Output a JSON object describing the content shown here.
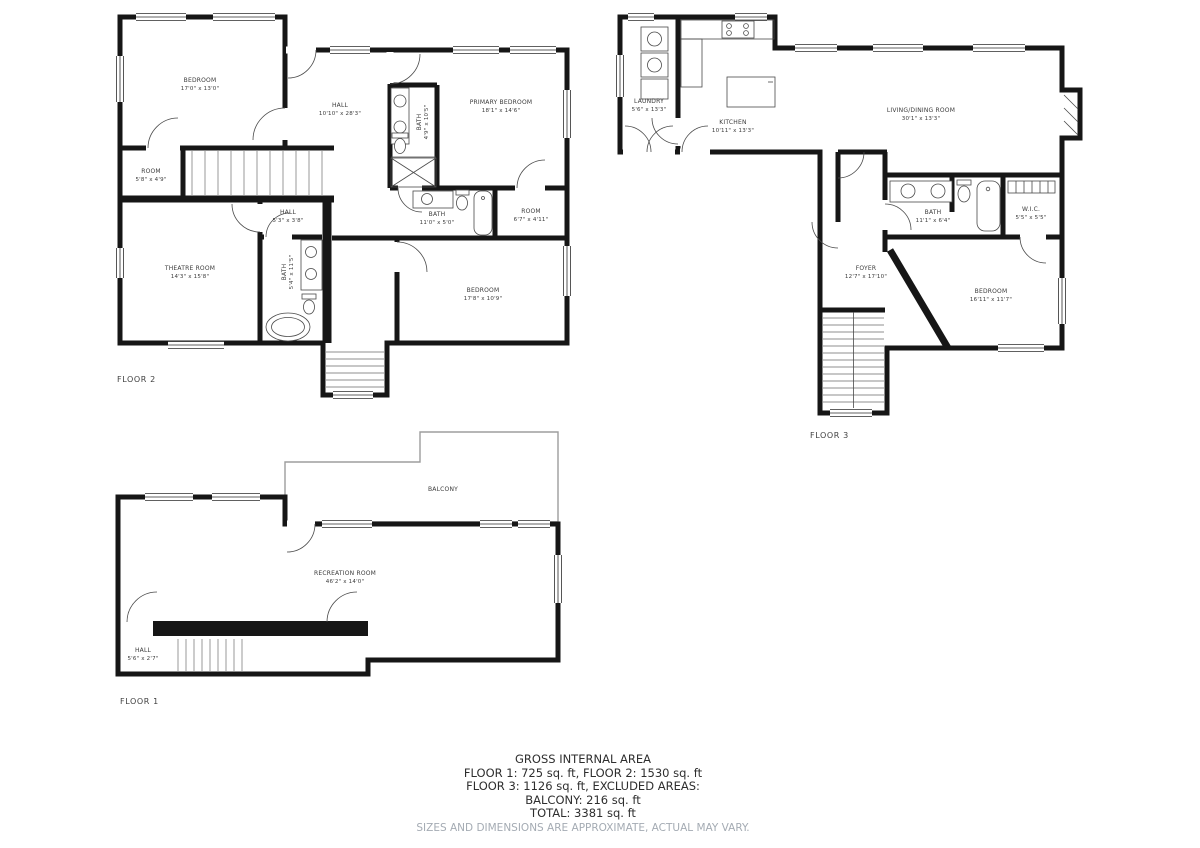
{
  "footer": {
    "title": "GROSS INTERNAL AREA",
    "line1": "FLOOR 1: 725 sq. ft, FLOOR 2: 1530 sq. ft",
    "line2": "FLOOR 3: 1126 sq. ft, EXCLUDED AREAS:",
    "line3": "BALCONY: 216 sq. ft",
    "line4": "TOTAL: 3381 sq. ft",
    "disclaimer": "SIZES AND DIMENSIONS ARE APPROXIMATE, ACTUAL MAY VARY."
  },
  "colors": {
    "wall": "#161616",
    "label_text": "#3b3b3b",
    "disclaimer_text": "#a4abb3",
    "balcony_outline": "#9d9d9d"
  },
  "floor2": {
    "label": "FLOOR 2",
    "rooms": {
      "bedroom_tl": {
        "name": "BEDROOM",
        "dims": "17'0\" x 13'0\""
      },
      "hall_main": {
        "name": "HALL",
        "dims": "10'10\" x 28'3\""
      },
      "primary": {
        "name": "PRIMARY BEDROOM",
        "dims": "18'1\" x 14'6\""
      },
      "bath_primary": {
        "name": "BATH",
        "dims": "4'9\" x 10'5\""
      },
      "room_small": {
        "name": "ROOM",
        "dims": "5'8\" x 4'9\""
      },
      "hall_small": {
        "name": "HALL",
        "dims": "5'3\" x 3'8\""
      },
      "theatre": {
        "name": "THEATRE ROOM",
        "dims": "14'3\" x 15'8\""
      },
      "bath_theatre": {
        "name": "BATH",
        "dims": "5'4\" x 11'5\""
      },
      "bath_mid": {
        "name": "BATH",
        "dims": "11'0\" x 5'0\""
      },
      "room_mid": {
        "name": "ROOM",
        "dims": "6'7\" x 4'11\""
      },
      "bedroom_b": {
        "name": "BEDROOM",
        "dims": "17'8\" x 10'9\""
      }
    }
  },
  "floor3": {
    "label": "FLOOR 3",
    "rooms": {
      "laundry": {
        "name": "LAUNDRY",
        "dims": "5'6\" x 13'3\""
      },
      "kitchen": {
        "name": "KITCHEN",
        "dims": "10'11\" x 13'3\""
      },
      "living": {
        "name": "LIVING/DINING ROOM",
        "dims": "30'1\" x 13'3\""
      },
      "bath": {
        "name": "BATH",
        "dims": "11'1\" x 6'4\""
      },
      "wic": {
        "name": "W.I.C.",
        "dims": "5'5\" x 5'5\""
      },
      "foyer": {
        "name": "FOYER",
        "dims": "12'7\" x 17'10\""
      },
      "bedroom": {
        "name": "BEDROOM",
        "dims": "16'11\" x 11'7\""
      }
    }
  },
  "floor1": {
    "label": "FLOOR 1",
    "rooms": {
      "balcony": {
        "name": "BALCONY"
      },
      "recreation": {
        "name": "RECREATION ROOM",
        "dims": "46'2\" x 14'0\""
      },
      "hall": {
        "name": "HALL",
        "dims": "5'6\" x 2'7\""
      }
    }
  }
}
